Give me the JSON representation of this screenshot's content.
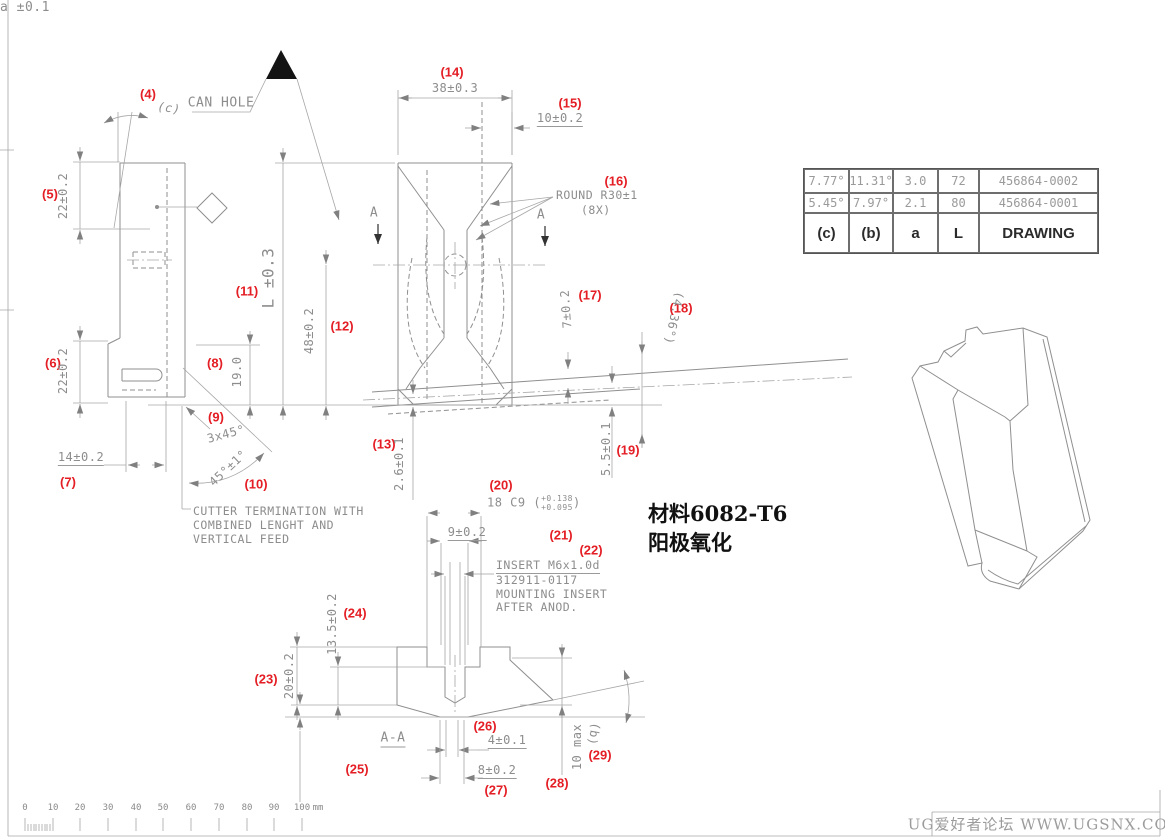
{
  "flags": {
    "can_hole": "CAN HOLE"
  },
  "callouts": {
    "c4": "(4)",
    "c5": "(5)",
    "c6": "(6)",
    "c7": "(7)",
    "c8": "(8)",
    "c9": "(9)",
    "c10": "(10)",
    "c11": "(11)",
    "c12": "(12)",
    "c13": "(13)",
    "c14": "(14)",
    "c15": "(15)",
    "c16": "(16)",
    "c17": "(17)",
    "c18": "(18)",
    "c19": "(19)",
    "c20": "(20)",
    "c21": "(21)",
    "c22": "(22)",
    "c23": "(23)",
    "c24": "(24)",
    "c25": "(25)",
    "c26": "(26)",
    "c27": "(27)",
    "c28": "(28)",
    "c29": "(29)"
  },
  "dims": {
    "d4": "(c)",
    "d5": "22±0.2",
    "d6": "22±0.2",
    "d7": "14±0.2",
    "d8": "19.0",
    "d9": "3x45°",
    "d10": "45°±1°",
    "d11": "L ±0.3",
    "d12": "48±0.2",
    "d13": "2.6±0.1",
    "d14": "38±0.3",
    "d15": "10±0.2",
    "d17": "7±0.2",
    "d18": "(4.36°)",
    "d19": "5.5±0.1",
    "d20": "18 C9",
    "d20_open": "(",
    "d20_upper": "+0.138",
    "d20_lower": "+0.095",
    "d20_close": ")",
    "d21": "9±0.2",
    "d23": "20±0.2",
    "d24": "13.5±0.2",
    "d25": "a ±0.1",
    "d26": "4±0.1",
    "d27": "8±0.2",
    "d28": "10 max",
    "d29": "(b)"
  },
  "notes": {
    "round_l1": "ROUND R30±1",
    "round_l2": "(8X)",
    "cutter_l1": "CUTTER TERMINATION WITH",
    "cutter_l2": "COMBINED LENGHT AND",
    "cutter_l3": "VERTICAL FEED",
    "insert_l1": "INSERT M6x1.0d",
    "insert_l2": "312911-0117",
    "insert_l3": "MOUNTING INSERT",
    "insert_l4": "AFTER ANOD.",
    "section": "A-A",
    "marker_a": "A"
  },
  "material": {
    "l1": "材料6082-T6",
    "l2": "阳极氧化"
  },
  "table": {
    "headers": [
      "(c)",
      "(b)",
      "a",
      "L",
      "DRAWING"
    ],
    "rows": [
      [
        "7.77°",
        "11.31°",
        "3.0",
        "72",
        "456864-0002"
      ],
      [
        "5.45°",
        "7.97°",
        "2.1",
        "80",
        "456864-0001"
      ]
    ]
  },
  "ruler": {
    "labels": [
      "0",
      "10",
      "20",
      "30",
      "40",
      "50",
      "60",
      "70",
      "80",
      "90",
      "100"
    ],
    "unit": "mm"
  },
  "watermark": "UG爱好者论坛 WWW.UGSNX.COM",
  "colors": {
    "line": "#8f8f8f",
    "callout_red": "#e41e25",
    "flag_black": "#141414"
  }
}
